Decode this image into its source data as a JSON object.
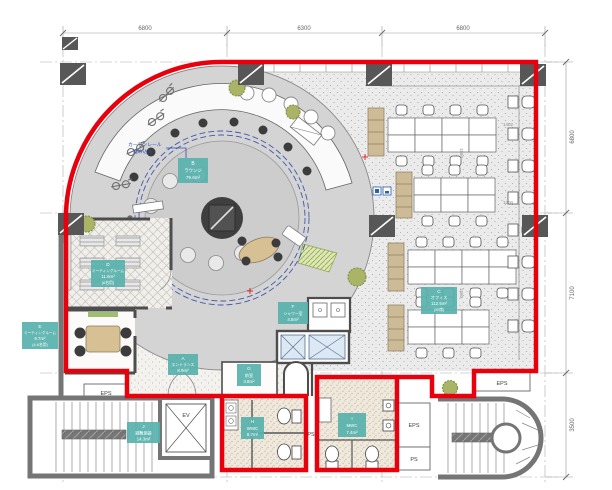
{
  "drawing": {
    "type": "architectural-floor-plan",
    "colors": {
      "lease_boundary_red": "#e8000d",
      "room_label_teal": "#58b2ac",
      "lounge_floor_gray": "#d4d4d4",
      "wall_dark": "#4d4d4d",
      "plant_green": "#aab466",
      "elevator_shaft_blue": "#dce8f4",
      "curtain_dash_blue": "#4456a8"
    }
  },
  "dimensions": {
    "top": [
      "6800",
      "6300",
      "6800"
    ],
    "right": [
      "6800",
      "7100",
      "3500"
    ]
  },
  "rooms": {
    "a": {
      "letter": "A",
      "name": "エントランス",
      "area": "8.9m²"
    },
    "b": {
      "letter": "B",
      "name": "ラウンジ",
      "area": "79.6m²"
    },
    "c": {
      "letter": "C",
      "name": "オフィス",
      "area": "112.5m²",
      "capacity": "(30席)"
    },
    "d": {
      "letter": "D",
      "name": "ミーティングルーム",
      "area": "11.6m²",
      "capacity": "(6名用)"
    },
    "e": {
      "letter": "E",
      "name": "ミーティングルーム",
      "area": "9.7m²",
      "capacity": "(4-6名用)"
    },
    "f": {
      "letter": "F",
      "name": "シャワー室",
      "area": "4.8m²"
    },
    "g": {
      "letter": "G",
      "name": "前室",
      "area": "3.8m²"
    },
    "h": {
      "letter": "H",
      "name": "WWC",
      "area": "8.7m²"
    },
    "i": {
      "letter": "I",
      "name": "MWC",
      "area": "7.4m²"
    },
    "j": {
      "letter": "J",
      "name": "避難施設",
      "area": "14.3m²"
    }
  },
  "annotations": {
    "curtain_line1": "カーテンレール",
    "curtain_line2": "埋め込み"
  },
  "service_labels": {
    "eps": "EPS",
    "ps": "PS",
    "ev": "EV"
  },
  "furniture_dims": [
    "1402",
    "1200",
    "1550",
    "1550"
  ]
}
